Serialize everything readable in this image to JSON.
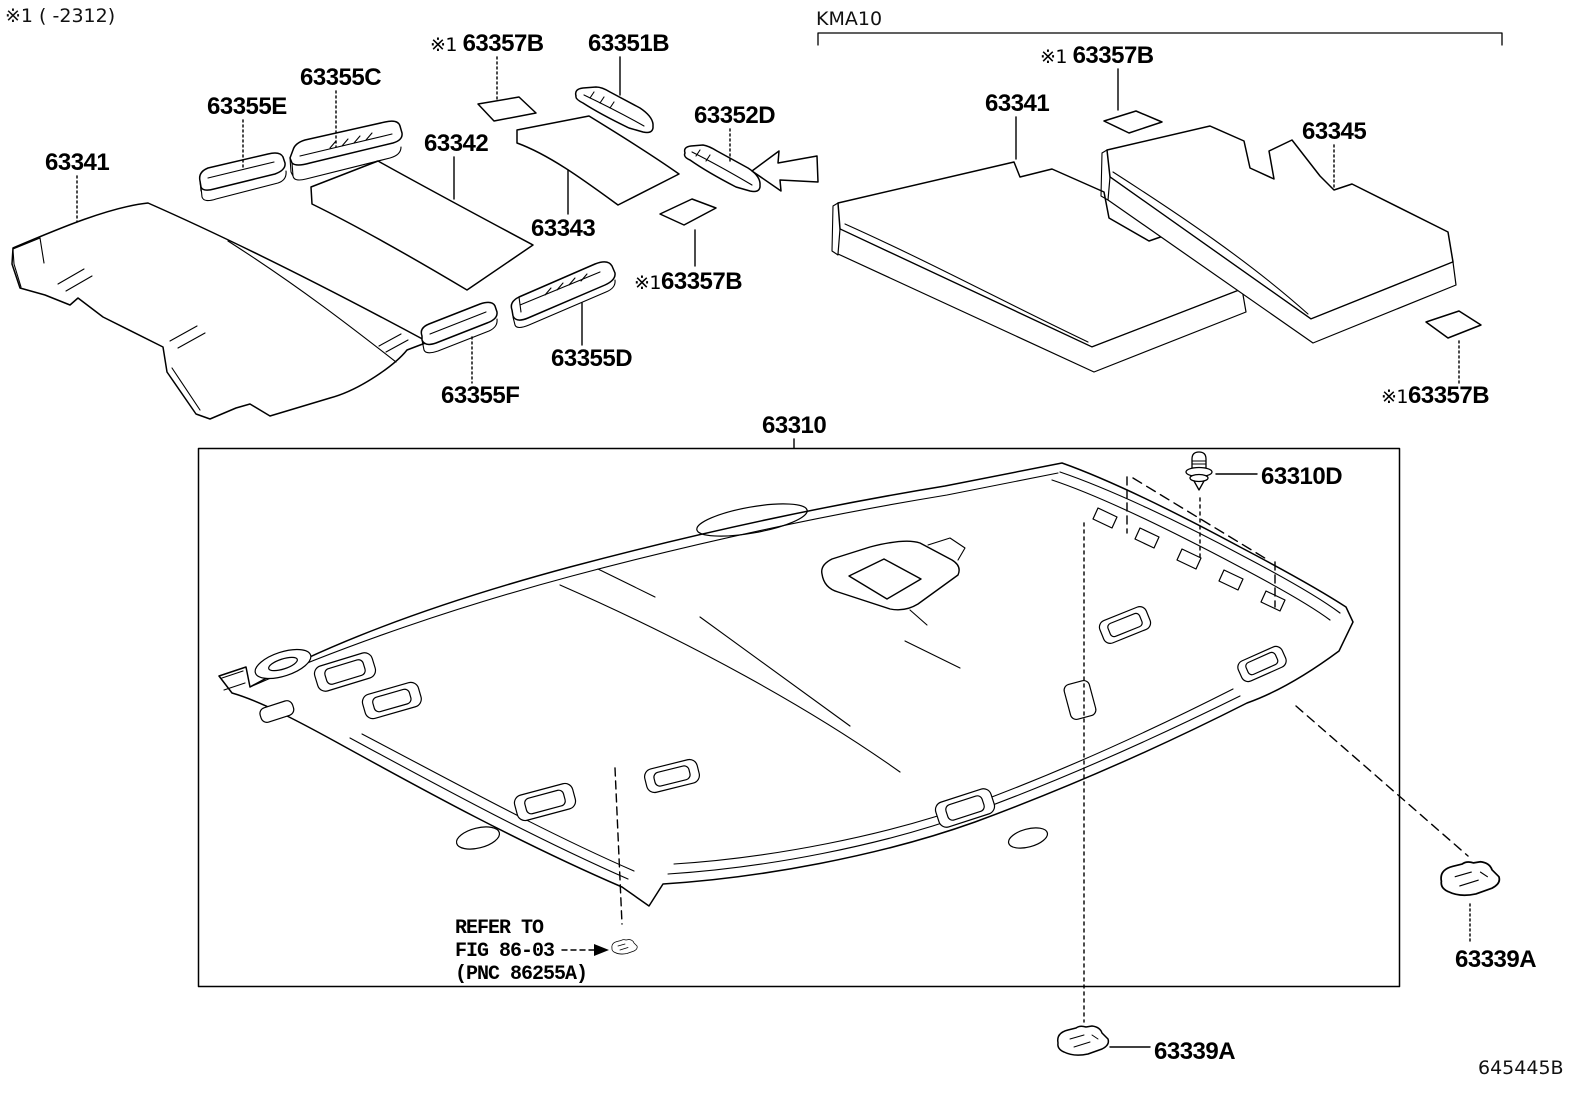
{
  "page": {
    "variant_note": "※1 (      -2312)",
    "group_code": "KMA10",
    "figure_number": "645445B"
  },
  "refer_note": {
    "line1": "REFER TO",
    "line2": "FIG 86-03",
    "line3": "(PNC 86255A)"
  },
  "labels": [
    {
      "id": "63341-left",
      "prefix": "",
      "number": "63341"
    },
    {
      "id": "63355E",
      "prefix": "",
      "number": "63355E"
    },
    {
      "id": "63355C",
      "prefix": "",
      "number": "63355C"
    },
    {
      "id": "63342",
      "prefix": "",
      "number": "63342"
    },
    {
      "id": "63357B-top-left",
      "prefix": "※1 ",
      "number": "63357B"
    },
    {
      "id": "63351B",
      "prefix": "",
      "number": "63351B"
    },
    {
      "id": "63352D",
      "prefix": "",
      "number": "63352D"
    },
    {
      "id": "63343",
      "prefix": "",
      "number": "63343"
    },
    {
      "id": "63357B-mid-left",
      "prefix": "※1",
      "number": "63357B"
    },
    {
      "id": "63355D",
      "prefix": "",
      "number": "63355D"
    },
    {
      "id": "63355F",
      "prefix": "",
      "number": "63355F"
    },
    {
      "id": "63357B-top-right",
      "prefix": "※1 ",
      "number": "63357B"
    },
    {
      "id": "63341-right",
      "prefix": "",
      "number": "63341"
    },
    {
      "id": "63345",
      "prefix": "",
      "number": "63345"
    },
    {
      "id": "63357B-right",
      "prefix": "※1",
      "number": "63357B"
    },
    {
      "id": "63310",
      "prefix": "",
      "number": "63310"
    },
    {
      "id": "63310D",
      "prefix": "",
      "number": "63310D"
    },
    {
      "id": "63339A-bottom",
      "prefix": "",
      "number": "63339A"
    },
    {
      "id": "63339A-right",
      "prefix": "",
      "number": "63339A"
    }
  ],
  "colors": {
    "line": "#000000",
    "background": "#ffffff"
  }
}
